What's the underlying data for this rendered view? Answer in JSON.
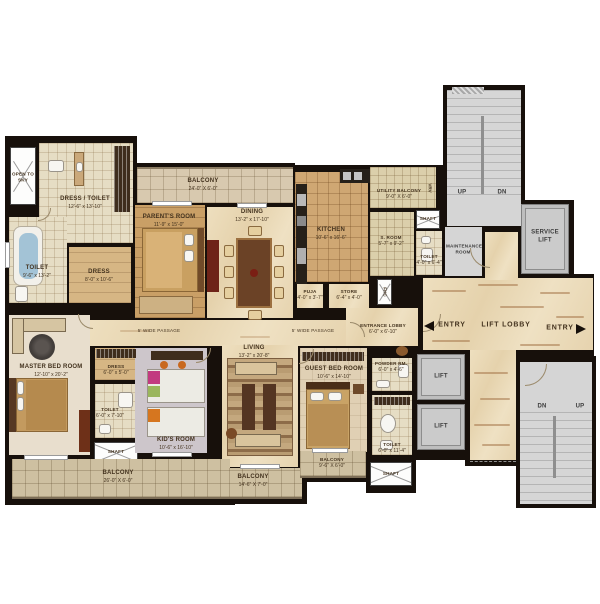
{
  "title": "Residential apartment floor plan",
  "colors": {
    "wall": "#17100b",
    "marble_floor": "#e9d8b5",
    "tile_floor": "#e6ddc4",
    "balcony_tile": "#cec0a1",
    "wood_floor": "#c99f66",
    "gray_area": "#d5d5d5",
    "label_text": "#43321e",
    "streak_accent": "#a5764a"
  },
  "rooms": {
    "open_to_sky": {
      "name": "OPEN TO SKY",
      "dims": ""
    },
    "dress_toilet": {
      "name": "DRESS / TOILET",
      "dims": "12'-6\" x 13'-10\""
    },
    "toilet_top": {
      "name": "TOILET",
      "dims": "9'-6\" x 13'-2\""
    },
    "dress_top": {
      "name": "DRESS",
      "dims": "8'-0\" x 10'-6\""
    },
    "parents_room": {
      "name": "PARENT'S ROOM",
      "dims": "11'-9\" x 15'-0\""
    },
    "balcony_top": {
      "name": "BALCONY",
      "dims": "24'-0\" X 6'-0\""
    },
    "dining": {
      "name": "DINING",
      "dims": "13'-2\" x 17'-10\""
    },
    "kitchen": {
      "name": "KITCHEN",
      "dims": "10'-6\" x 16'-6\""
    },
    "utility_balcony": {
      "name": "UTILITY BALCONY",
      "dims": "9'-0\" X 6'-0\""
    },
    "vrv": {
      "name": "VRV"
    },
    "shaft_top": {
      "name": "SHAFT"
    },
    "s_room": {
      "name": "S. ROOM",
      "dims": "5'-7\" x 9'-2\""
    },
    "toilet_s": {
      "name": "TOILET",
      "dims": "4'-0\" x 6'-4\""
    },
    "maintenance": {
      "name": "MAINTENANCE ROOM"
    },
    "stairs_top_up": {
      "name": "UP"
    },
    "stairs_top_dn": {
      "name": "DN"
    },
    "service_lift": {
      "name": "SERVICE LIFT"
    },
    "lift_lobby": {
      "name": "LIFT LOBBY"
    },
    "entry_left": {
      "name": "ENTRY"
    },
    "entry_right": {
      "name": "ENTRY"
    },
    "puja": {
      "name": "PUJA",
      "dims": "4'-0\" x 3'-7\""
    },
    "store": {
      "name": "STORE",
      "dims": "6'-4\" x 4'-0\""
    },
    "fhc": {
      "name": "FHC"
    },
    "entrance_lobby": {
      "name": "ENTRANCE LOBBY",
      "dims": "6'-0\" x 6'-10\""
    },
    "passage_left": {
      "name": "5'  WIDE PASSAGE"
    },
    "passage_right": {
      "name": "5'  WIDE PASSAGE"
    },
    "master_bed": {
      "name": "MASTER BED ROOM",
      "dims": "12'-10\" x 20'-2\""
    },
    "dress_master": {
      "name": "DRESS",
      "dims": "6'-0\" x 5'-0\""
    },
    "toilet_master": {
      "name": "TOILET",
      "dims": "6'-0\" x 7'-10\""
    },
    "shaft_master": {
      "name": "SHAFT"
    },
    "kids_room": {
      "name": "KID'S ROOM",
      "dims": "10'-6\" x 16'-10\""
    },
    "living": {
      "name": "LIVING",
      "dims": "13'-2\" x 20'-8\""
    },
    "guest_bed": {
      "name": "GUEST BED ROOM",
      "dims": "10'-6\" x 14'-10\""
    },
    "powder_rm": {
      "name": "POWDER RM.",
      "dims": "6'-0\" x 4'-6\""
    },
    "toilet_guest": {
      "name": "TOILET",
      "dims": "6'-0\" x 11'-4\""
    },
    "shaft_guest": {
      "name": "SHAFT"
    },
    "lift_1": {
      "name": "LIFT"
    },
    "lift_2": {
      "name": "LIFT"
    },
    "balcony_master": {
      "name": "BALCONY",
      "dims": "26'-0\" X 6'-0\""
    },
    "balcony_living": {
      "name": "BALCONY",
      "dims": "14'-6\" X 7'-0\""
    },
    "balcony_guest": {
      "name": "BALCONY",
      "dims": "9'-6\" X 6'-0\""
    },
    "stairs_bot_dn": {
      "name": "DN"
    },
    "stairs_bot_up": {
      "name": "UP"
    }
  }
}
